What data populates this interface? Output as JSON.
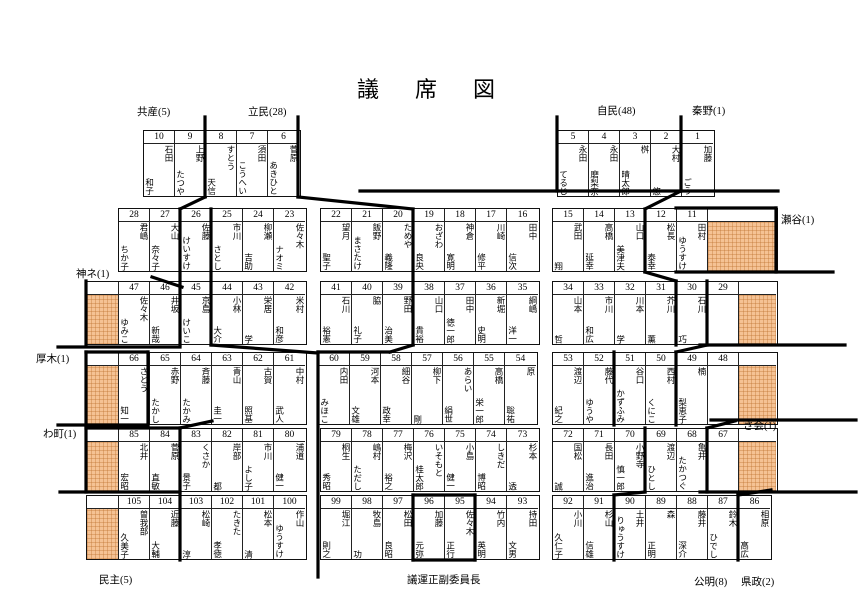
{
  "title": "議　席　図",
  "labels": [
    {
      "id": "kyosan",
      "text": "共産(5)"
    },
    {
      "id": "ritsumin",
      "text": "立民(28)"
    },
    {
      "id": "jimin",
      "text": "自民(48)"
    },
    {
      "id": "hadano",
      "text": "秦野(1)"
    },
    {
      "id": "seya",
      "text": "瀬谷(1)"
    },
    {
      "id": "kanane",
      "text": "神ネ(1)"
    },
    {
      "id": "atsugi",
      "text": "厚木(1)"
    },
    {
      "id": "wamachi",
      "text": "わ町(1)"
    },
    {
      "id": "sakai",
      "text": "さ会(1)"
    },
    {
      "id": "minshu",
      "text": "民主(5)"
    },
    {
      "id": "giun",
      "text": "議運正副委員長"
    },
    {
      "id": "komei",
      "text": "公明(8)"
    },
    {
      "id": "kensei",
      "text": "県政(2)"
    }
  ],
  "blocks": [
    {
      "id": "r1L",
      "cells": [
        {
          "n": "10",
          "s": "石田",
          "g": "和子"
        },
        {
          "n": "9",
          "s": "上野",
          "g": "たつや"
        },
        {
          "n": "8",
          "s": "すとう",
          "g": "天信"
        },
        {
          "n": "7",
          "s": "須田",
          "g": "こうへい"
        },
        {
          "n": "6",
          "s": "菅原",
          "g": "あきひと"
        }
      ]
    },
    {
      "id": "r1R",
      "cells": [
        {
          "n": "5",
          "s": "永田",
          "g": "てるじ"
        },
        {
          "n": "4",
          "s": "永田",
          "g": "磨梨奈"
        },
        {
          "n": "3",
          "s": "桝",
          "g": "晴太郎"
        },
        {
          "n": "2",
          "s": "大村",
          "g": "悠"
        },
        {
          "n": "1",
          "s": "加藤",
          "g": "ごう"
        }
      ]
    },
    {
      "id": "r2L",
      "cells": [
        {
          "n": "28",
          "s": "君嶋",
          "g": "ちか子"
        },
        {
          "n": "27",
          "s": "大山",
          "g": "奈々子"
        },
        {
          "n": "26",
          "s": "佐藤",
          "g": "けいすけ"
        },
        {
          "n": "25",
          "s": "市川",
          "g": "さとし"
        },
        {
          "n": "24",
          "s": "柳瀬",
          "g": "吉助"
        },
        {
          "n": "23",
          "s": "佐々木",
          "g": "ナオミ"
        }
      ]
    },
    {
      "id": "r2M",
      "cells": [
        {
          "n": "22",
          "s": "望月",
          "g": "聖子"
        },
        {
          "n": "21",
          "s": "飯野",
          "g": "まさたけ"
        },
        {
          "n": "20",
          "s": "ためや",
          "g": "義隆"
        },
        {
          "n": "19",
          "s": "おざわ",
          "g": "良央"
        },
        {
          "n": "18",
          "s": "神倉",
          "g": "寛明"
        },
        {
          "n": "17",
          "s": "川崎",
          "g": "修平"
        },
        {
          "n": "16",
          "s": "田中",
          "g": "信次"
        }
      ]
    },
    {
      "id": "r2R",
      "cells": [
        {
          "n": "15",
          "s": "武田",
          "g": "翔"
        },
        {
          "n": "14",
          "s": "高橋",
          "g": "延幸"
        },
        {
          "n": "13",
          "s": "山口",
          "g": "美津夫"
        },
        {
          "n": "12",
          "s": "松長",
          "g": "泰幸"
        },
        {
          "n": "11",
          "s": "田村",
          "g": "ゆうすけ"
        },
        {
          "o": 1,
          "w": 68
        }
      ]
    },
    {
      "id": "r3L",
      "cells": [
        {
          "o": 1,
          "w": 32
        },
        {
          "n": "47",
          "s": "佐々木",
          "g": "ゆみこ"
        },
        {
          "n": "46",
          "s": "井坂",
          "g": "新哉"
        },
        {
          "n": "45",
          "s": "京島",
          "g": "けいこ"
        },
        {
          "n": "44",
          "s": "小林",
          "g": "大介"
        },
        {
          "n": "43",
          "s": "栄居",
          "g": "学"
        },
        {
          "n": "42",
          "s": "米村",
          "g": "和彦"
        }
      ]
    },
    {
      "id": "r3M",
      "cells": [
        {
          "n": "41",
          "s": "石川",
          "g": "裕憲"
        },
        {
          "n": "40",
          "s": "脇",
          "g": "礼子"
        },
        {
          "n": "39",
          "s": "野田",
          "g": "治美"
        },
        {
          "n": "38",
          "s": "山口",
          "g": "貴裕"
        },
        {
          "n": "37",
          "s": "田中",
          "g": "徳一郎"
        },
        {
          "n": "36",
          "s": "新堀",
          "g": "史明"
        },
        {
          "n": "35",
          "s": "綱嶋",
          "g": "洋一"
        }
      ]
    },
    {
      "id": "r3R",
      "cells": [
        {
          "n": "34",
          "s": "山本",
          "g": "哲"
        },
        {
          "n": "33",
          "s": "市川",
          "g": "和広"
        },
        {
          "n": "32",
          "s": "川本",
          "g": "学"
        },
        {
          "n": "31",
          "s": "芥川",
          "g": "薫"
        },
        {
          "n": "30",
          "s": "石川",
          "g": "巧"
        },
        {
          "n": "29"
        },
        {
          "o": 1,
          "w": 37
        }
      ]
    },
    {
      "id": "r4L",
      "cells": [
        {
          "o": 1,
          "w": 32
        },
        {
          "n": "66",
          "s": "さとう",
          "g": "知一"
        },
        {
          "n": "65",
          "s": "赤野",
          "g": "たかし"
        },
        {
          "n": "64",
          "s": "斉藤",
          "g": "たかみ"
        },
        {
          "n": "63",
          "s": "青山",
          "g": "圭一"
        },
        {
          "n": "62",
          "s": "古賀",
          "g": "照基"
        },
        {
          "n": "61",
          "s": "中村",
          "g": "武人"
        }
      ]
    },
    {
      "id": "r4M",
      "cells": [
        {
          "n": "60",
          "s": "内田",
          "g": "みほこ"
        },
        {
          "n": "59",
          "s": "河本",
          "g": "文雄"
        },
        {
          "n": "58",
          "s": "細谷",
          "g": "政幸"
        },
        {
          "n": "57",
          "s": "柳下",
          "g": "剛"
        },
        {
          "n": "56",
          "s": "あらい",
          "g": "絹世"
        },
        {
          "n": "55",
          "s": "高橋",
          "g": "栄一郎"
        },
        {
          "n": "54",
          "s": "原",
          "g": "聡祐"
        }
      ]
    },
    {
      "id": "r4R",
      "cells": [
        {
          "n": "53",
          "s": "渡辺",
          "g": "紀之"
        },
        {
          "n": "52",
          "s": "藤代",
          "g": "ゆうや"
        },
        {
          "n": "51",
          "s": "谷口",
          "g": "かずふみ"
        },
        {
          "n": "50",
          "s": "西村",
          "g": "くにこ"
        },
        {
          "n": "49",
          "s": "楠",
          "g": "梨恵子"
        },
        {
          "n": "48"
        },
        {
          "o": 1,
          "w": 37
        }
      ]
    },
    {
      "id": "r5L",
      "cells": [
        {
          "o": 1,
          "w": 32
        },
        {
          "n": "85",
          "s": "北井",
          "g": "宏昭"
        },
        {
          "n": "84",
          "s": "菅原",
          "g": "直敏"
        },
        {
          "n": "83",
          "s": "くさか",
          "g": "景子"
        },
        {
          "n": "82",
          "s": "岸部",
          "g": "都"
        },
        {
          "n": "81",
          "s": "市川",
          "g": "よし子"
        },
        {
          "n": "80",
          "s": "浦道",
          "g": "健一"
        }
      ]
    },
    {
      "id": "r5M",
      "cells": [
        {
          "n": "79",
          "s": "桐生",
          "g": "秀昭"
        },
        {
          "n": "78",
          "s": "嶋村",
          "g": "ただし"
        },
        {
          "n": "77",
          "s": "梅沢",
          "g": "裕之"
        },
        {
          "n": "76",
          "s": "いそもと",
          "g": "桂太郎"
        },
        {
          "n": "75",
          "s": "小島",
          "g": "健一"
        },
        {
          "n": "74",
          "s": "しきだ",
          "g": "博昭"
        },
        {
          "n": "73",
          "s": "杉本",
          "g": "透"
        }
      ]
    },
    {
      "id": "r5R",
      "cells": [
        {
          "n": "72",
          "s": "国松",
          "g": "誠"
        },
        {
          "n": "71",
          "s": "長田",
          "g": "進治"
        },
        {
          "n": "70",
          "s": "小野寺",
          "g": "慎一郎"
        },
        {
          "n": "69",
          "s": "渡辺",
          "g": "ひとし"
        },
        {
          "n": "68",
          "s": "亀井",
          "g": "たかつぐ"
        },
        {
          "n": "67"
        },
        {
          "o": 1,
          "w": 37
        }
      ]
    },
    {
      "id": "r6L",
      "cells": [
        {
          "o": 1,
          "w": 32
        },
        {
          "n": "105",
          "s": "曽我部",
          "g": "久美子"
        },
        {
          "n": "104",
          "s": "近藤",
          "g": "大輔"
        },
        {
          "n": "103",
          "s": "松崎",
          "g": "淳"
        },
        {
          "n": "102",
          "s": "たきた",
          "g": "孝徳"
        },
        {
          "n": "101",
          "s": "松本",
          "g": "清"
        },
        {
          "n": "100",
          "s": "作山",
          "g": "ゆうすけ"
        }
      ]
    },
    {
      "id": "r6M",
      "cells": [
        {
          "n": "99",
          "s": "堀江",
          "g": "則之"
        },
        {
          "n": "98",
          "s": "牧島",
          "g": "功"
        },
        {
          "n": "97",
          "s": "松田",
          "g": "良昭"
        },
        {
          "n": "96",
          "s": "加藤",
          "g": "元弥"
        },
        {
          "n": "95",
          "s": "佐々木",
          "g": "正行"
        },
        {
          "n": "94",
          "s": "竹内",
          "g": "英明"
        },
        {
          "n": "93",
          "s": "持田",
          "g": "文男"
        }
      ]
    },
    {
      "id": "r6R",
      "cells": [
        {
          "n": "92",
          "s": "小川",
          "g": "久仁子"
        },
        {
          "n": "91",
          "s": "杉山",
          "g": "信雄"
        },
        {
          "n": "90",
          "s": "土井",
          "g": "りゅうすけ"
        },
        {
          "n": "89",
          "s": "森",
          "g": "正明"
        },
        {
          "n": "88",
          "s": "藤井",
          "g": "深介"
        },
        {
          "n": "87",
          "s": "鈴木",
          "g": "ひでし"
        },
        {
          "n": "86",
          "s": "相原",
          "g": "高広"
        }
      ]
    }
  ]
}
